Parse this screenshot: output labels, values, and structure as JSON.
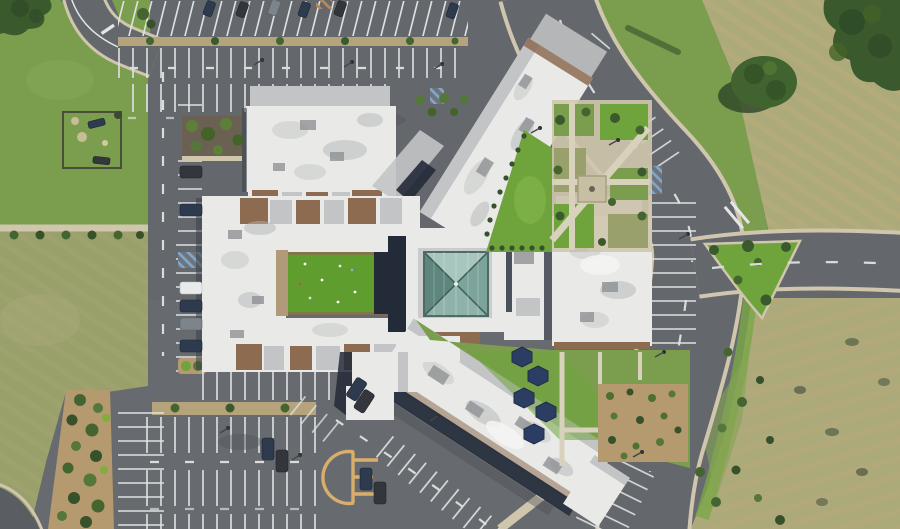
{
  "scene": {
    "description": "Aerial drone photo, top-down view of a large school campus: white-roofed building with radiating wings around a central teal glass pyramid skylight, green turf courtyard, landscaped gardens with shade canopies, surrounded by parking lots, a curved loop road and grass fields.",
    "type": "aerial-photograph",
    "no_text_visible": true
  },
  "palette": {
    "asphalt": "#64676b",
    "asphalt_dark": "#595c60",
    "grass_green": "#7b9e4e",
    "grass_olive": "#99a06b",
    "grass_bright": "#6fa43c",
    "turf_green": "#5f9e2e",
    "field_dry": "#aca97b",
    "roof_white": "#e9eae7",
    "roof_gray": "#c2c4c5",
    "roof_brown": "#8d6b50",
    "roof_tan": "#b09a7a",
    "shadow_navy": "#232a38",
    "skylight_teal_light": "#a7c6be",
    "skylight_teal": "#7da49b",
    "skylight_teal_dark": "#5f867e",
    "canopy_navy": "#2c3d63",
    "mulch": "#b5996f",
    "path_tan": "#cfc6ad",
    "line_white": "#e2e4e6",
    "marking_yellow": "#d9ae6a",
    "hatch_blue": "#7fa8cc",
    "hatch_orange": "#b98a55",
    "tree_dark": "#3a5a2e"
  }
}
